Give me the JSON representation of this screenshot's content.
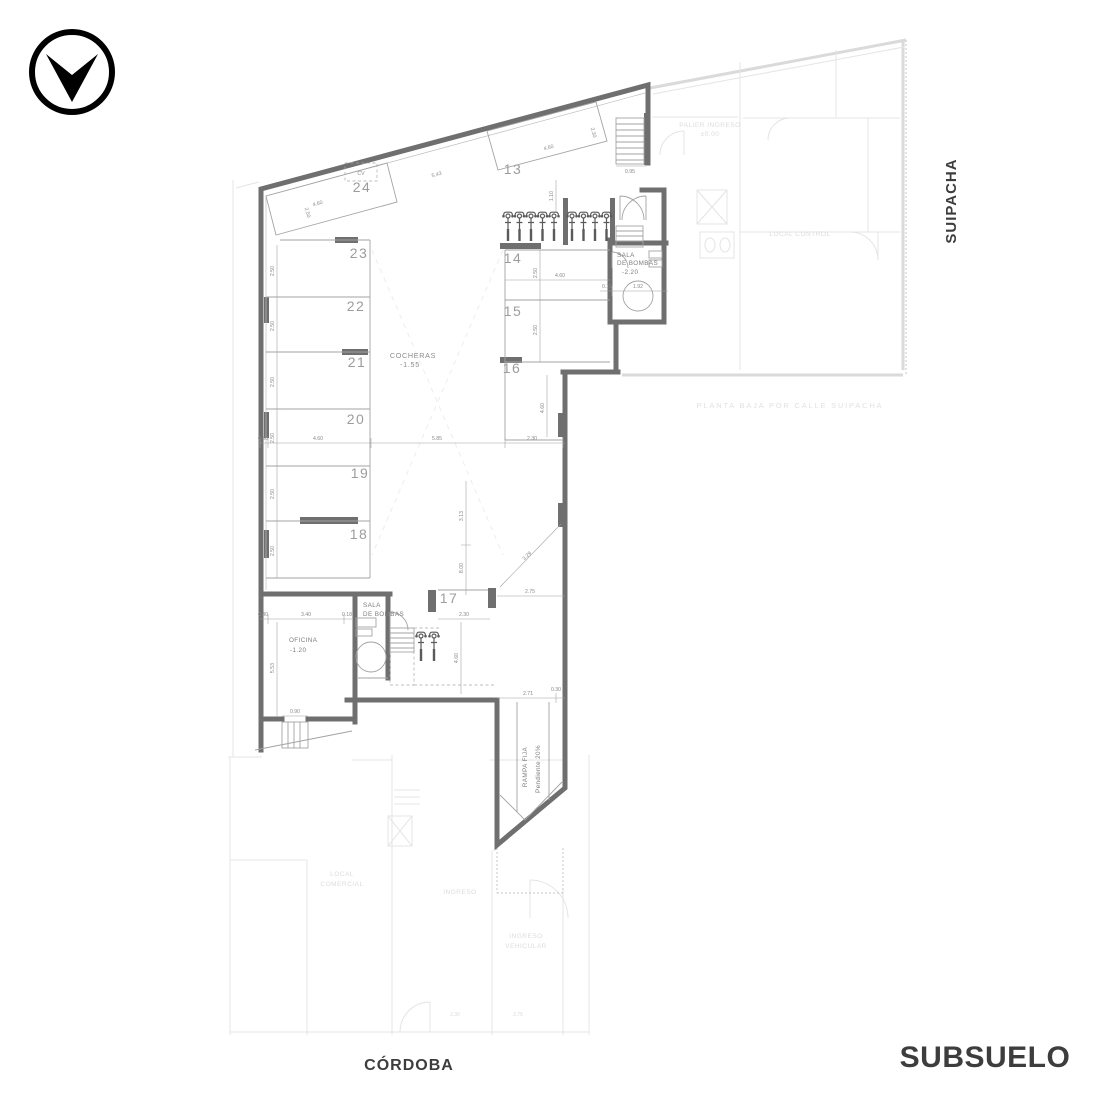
{
  "icons": {
    "logo": "down-arrow-in-circle",
    "bike": "motorcycle-front-view"
  },
  "labels": {
    "plan_name": "SUBSUELO",
    "street_bottom": "CÓRDOBA",
    "street_right": "SUIPACHA"
  },
  "rooms": {
    "cocheras": {
      "name": "COCHERAS",
      "level": "-1.55"
    },
    "sala_top": {
      "l1": "SALA",
      "l2": "DE BOMBAS",
      "level": "-2.20"
    },
    "sala_bottom": {
      "l1": "SALA",
      "l2": "DE BOMBAS"
    },
    "oficina": {
      "name": "OFICINA",
      "level": "-1.20"
    },
    "rampa": {
      "l1": "RAMPA FIJA",
      "l2": "Pendiente 20%"
    },
    "cv": "CV"
  },
  "parking": {
    "spaces": [
      "13",
      "14",
      "15",
      "16",
      "17",
      "18",
      "19",
      "20",
      "21",
      "22",
      "23",
      "24"
    ]
  },
  "dims": {
    "aisle_top": "5.43",
    "bay24_len": "4.60",
    "bay24_w": "2.50",
    "bay13_len": "4.60",
    "bay13_w": "2.30",
    "bike_row": "1.10",
    "stair_top": "0.95",
    "sala_a": "0.15",
    "sala_b": "1.92",
    "bay14_len": "4.60",
    "bay14_w": "2.50",
    "bay15_w": "2.50",
    "bay16_d": "4.60",
    "chain_wall": "0.30",
    "chain_bay": "4.60",
    "chain_aisle": "5.85",
    "chain_right": "2.30",
    "bay_w": "2.50",
    "v_a": "3.13",
    "v_b": "8.00",
    "diag": "3.29",
    "s17_top": "2.75",
    "s17_w": "2.30",
    "s17_d": "4.60",
    "ramp_a": "2.71",
    "ramp_b": "0.30",
    "off_wall": "0.30",
    "off_w": "3.40",
    "off_t": "0.18",
    "off_h": "5.53",
    "off_door": "0.90",
    "fb_a": "2.30",
    "fb_b": "2.75"
  },
  "faded": {
    "palier_l1": "PALIER INGRESO",
    "palier_l2": "±0.00",
    "local_control": "LOCAL CONTROL",
    "planta_baja": "PLANTA BAJA POR CALLE SUIPACHA",
    "local_l1": "LOCAL",
    "local_l2": "COMERCIAL",
    "ingreso": "INGRESO",
    "ing_veh_l1": "INGRESO",
    "ing_veh_l2": "VEHICULAR"
  },
  "colors": {
    "wall": "#6f6f6f",
    "line": "#a3a3a3",
    "dim_text": "#8a8a8a",
    "title_text": "#3d3d3d",
    "faded": "#e4e4e4"
  }
}
